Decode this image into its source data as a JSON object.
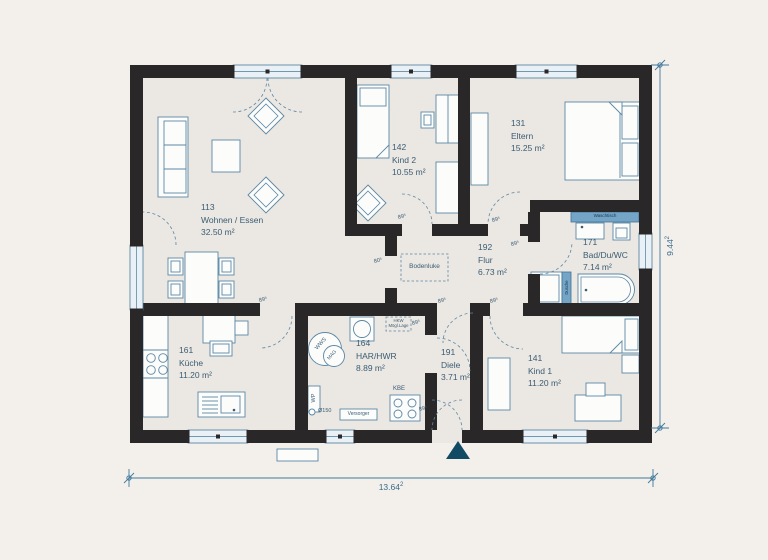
{
  "plan": {
    "rooms": [
      {
        "number": "113",
        "name": "Wohnen / Essen",
        "area": "32.50 m²"
      },
      {
        "number": "142",
        "name": "Kind 2",
        "area": "10.55 m²"
      },
      {
        "number": "131",
        "name": "Eltern",
        "area": "15.25 m²"
      },
      {
        "number": "171",
        "name": "Bad/Du/WC",
        "area": "7.14 m²"
      },
      {
        "number": "192",
        "name": "Flur",
        "area": "6.73 m²"
      },
      {
        "number": "161",
        "name": "Küche",
        "area": "11.20 m²"
      },
      {
        "number": "164",
        "name": "HAR/HWR",
        "area": "8.89 m²"
      },
      {
        "number": "191",
        "name": "Diele",
        "area": "3.71 m²"
      },
      {
        "number": "141",
        "name": "Kind 1",
        "area": "11.20 m²"
      }
    ],
    "door_labels": [
      "89⁵",
      "89⁵",
      "89⁵",
      "80⁵",
      "89⁵",
      "89⁵",
      "89⁵",
      "89⁵",
      "89⁵"
    ],
    "equipment": {
      "bodenluke": "Bodenluke",
      "hkw_line1": "HKW",
      "hkw_line2": "Mögl.Lage",
      "wws": "WWS",
      "mag": "MAG",
      "wp": "WP",
      "pipe": "Ø150",
      "versorger": "Versorger",
      "kbe": "KBE",
      "waschtisch": "Waschtisch",
      "dusche": "Dusche"
    },
    "dimensions": {
      "width": {
        "value": "13.64",
        "exp": "2"
      },
      "height": {
        "value": "9.44",
        "exp": "2"
      }
    },
    "colors": {
      "wall": "#2a2728",
      "floor": "#ebe7e2",
      "line": "#5b87a5",
      "accent_blue": "#74a5c6",
      "text": "#3a5d74",
      "north_marker": "#134a63",
      "window": "#e9f1f6",
      "dim": "#41799c"
    }
  }
}
